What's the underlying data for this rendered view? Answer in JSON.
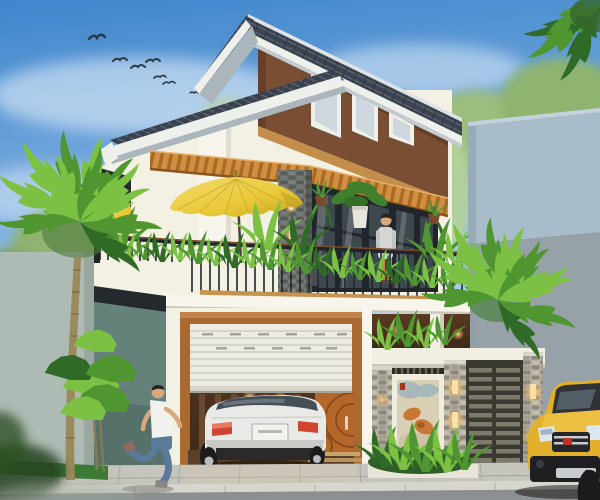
{
  "meta": {
    "title": "Architectural exterior rendering of a modern two-and-a-half storey tropical house",
    "render_type": "3d-visualization",
    "canvas": {
      "width": 600,
      "height": 500
    }
  },
  "palette": {
    "sky_top": "#3f86cd",
    "sky_mid": "#7fb0e0",
    "sky_low": "#c6dcef",
    "sky_horizon": "#dcebf5",
    "cloud": "#ffffff",
    "bird": "#2b3b47",
    "tree_soft": "#9cbd7e",
    "tree_soft2": "#8fb470",
    "tree_light": "#b7d498",
    "palm_bright": "#7cc144",
    "palm_mid": "#4f9630",
    "palm_deep": "#2f6b26",
    "trunk": "#9a8a5c",
    "trunk_ring": "#7a6a44",
    "neighbor_light": "#a9bcc9",
    "neighbor_dark": "#97a1a8",
    "left_wall": "#aebbb5",
    "roof_tile": "#3a434f",
    "roof_tile_light": "#59636e",
    "fascia": "#eef0ec",
    "soffit": "#aab6bc",
    "ridge": "#dfe3e6",
    "attic_brown": "#7a4e33",
    "attic_brown_dark": "#5e3a24",
    "trim_tan": "#c38d4a",
    "wall_cream": "#f3f0e4",
    "wall_bright": "#f7f5ec",
    "wall_shadow": "#e0ddd0",
    "awning_wood": "#d18f3f",
    "awning_dark": "#a96a26",
    "glass_dark": "#3d474e",
    "glass_frame": "#20262b",
    "glass_reflect": "#8ba2ac",
    "railing_dark": "#20252a",
    "rail_wood": "#7c4c28",
    "planter_wood": "#c6924e",
    "umbrella_yellow": "#e9c838",
    "umbrella_shadow": "#c7a422",
    "umbrella_light": "#f4dc6e",
    "teal_wall": "#64817a",
    "teal_dark": "#4d665f",
    "side_window": "#262c30",
    "garage_wood": "#a86a30",
    "shutter_white": "#edece4",
    "shutter_line": "#c9c7bb",
    "interior_dark": "#3c2819",
    "interior_warm": "#7c5634",
    "lamp_glow": "#f6bf62",
    "door_orange": "#b5672a",
    "door_arc": "#8a4c1c",
    "step_wood": "#caa36a",
    "car_white": "#e9e9e7",
    "car_shade": "#c9c9c5",
    "car_glass": "#474f56",
    "taillight": "#d14430",
    "plate": "#f2f2ee",
    "tire": "#1b1b1e",
    "rim": "#b9bcbe",
    "mural_frame": "#efece0",
    "mural_bg": "#d9cfb4",
    "koi_orange": "#c87836",
    "mural_blue": "#9fb4b8",
    "stamp_red": "#b03020",
    "gate_frame": "#3b3a32",
    "gate_slat": "#7d7a6c",
    "pillar_stone": "#b5b1a4",
    "pillar_spot": "#8d887a",
    "suv_yellow": "#e2b02a",
    "suv_dark": "#26262a",
    "suv_chrome": "#c8ccd0",
    "suv_red": "#c03028",
    "pave": "#c6c5bd",
    "pave_line": "#a7a79f",
    "curb": "#d7d6ce",
    "road": "#84878a",
    "grass": "#3a7a33",
    "skin": "#d9a87c",
    "hair": "#2a2420",
    "shirt_white": "#f1f1ee",
    "jeans": "#5a7a9a",
    "pants_orange": "#c8803c",
    "shirt_gray": "#d4d6d6"
  },
  "scene": {
    "sky": {
      "description": "blue sky with soft white clouds",
      "birds_count": 7
    },
    "background": {
      "left": "blurred neighbour wall with trees",
      "right": "plain two-tone grey neighbour building",
      "trees": "soft green canopies behind the house"
    },
    "house": {
      "attic": {
        "wall": "brown gable",
        "windows": 3,
        "roof": "dark tiled mono-pitch with white fascia"
      },
      "second_floor": {
        "features": [
          "full-width glass doors with dark frames",
          "timber slat awning",
          "stacked-stone pillar with two wall lamps",
          "balcony with black railing and timber planter",
          "tropical plants",
          "yellow patio umbrella",
          "small yellow umbrella tip at left corner",
          "two hanging plant pots",
          "potted plant with white pot",
          "man standing"
        ]
      },
      "ground_floor": {
        "features": [
          "half-open white roller garage door in timber frame",
          "white sedan parked inside with lit ceiling",
          "orange timber door inside garage",
          "recessed porch",
          "white header beam",
          "framed koi art mural",
          "three stacked-stone gate pillars with warm lamps",
          "dark slatted metal gate"
        ]
      }
    },
    "foreground": {
      "vehicles": [
        "white sedan (rear view) in garage",
        "yellow SUV front at right edge"
      ],
      "people": [
        "man running on the sidewalk",
        "man standing on the balcony"
      ],
      "plants": [
        "tall palm tree left",
        "rosette shrubs left",
        "palm crown right",
        "shrubs at gate",
        "dark foliage top-right corner"
      ],
      "street": [
        "paver sidewalk",
        "grass strip at left",
        "kerb row",
        "road edge"
      ]
    }
  }
}
